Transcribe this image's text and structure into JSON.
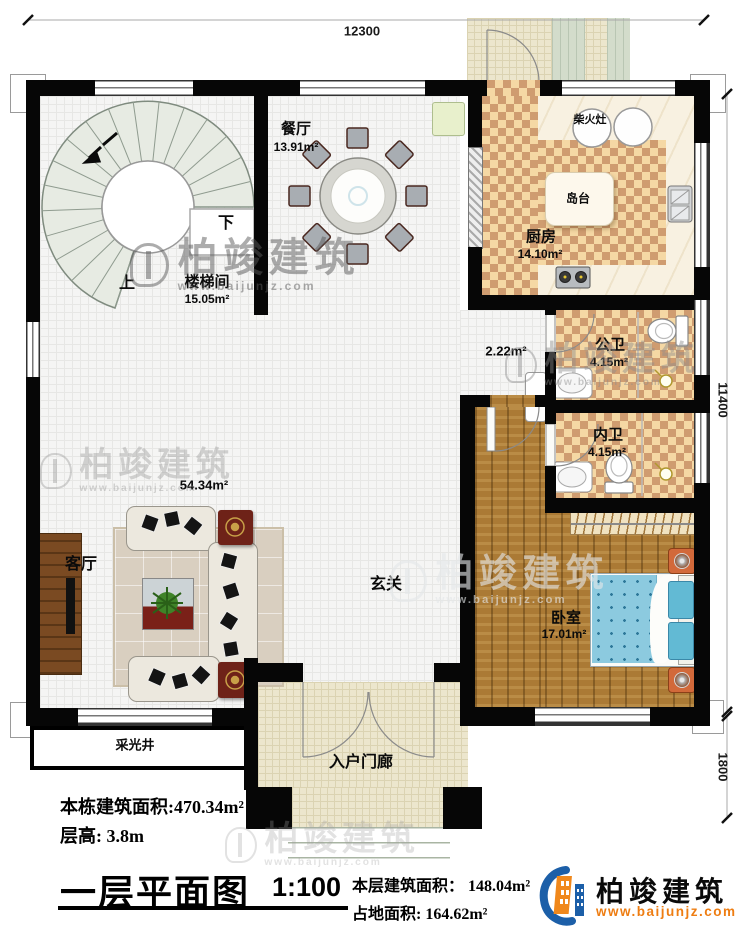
{
  "plan": {
    "dims": {
      "width": "12300",
      "height_main": "11400",
      "height_porch": "1800"
    },
    "stairwell": {
      "label": "楼梯间",
      "area": "15.05m²",
      "up": "上",
      "down": "下"
    },
    "dining": {
      "label": "餐厅",
      "area": "13.91m²"
    },
    "kitchen": {
      "label": "厨房",
      "area": "14.10m²",
      "island": "岛台",
      "wood_stove": "柴火灶"
    },
    "public_bath": {
      "label": "公卫",
      "area": "4.15m²"
    },
    "inner_bath": {
      "label": "内卫",
      "area": "4.15m²"
    },
    "corridor": {
      "area": "2.22m²"
    },
    "bedroom": {
      "label": "卧室",
      "area": "17.01m²"
    },
    "foyer": {
      "label": "玄关"
    },
    "living": {
      "label": "客厅",
      "area": "54.34m²"
    },
    "lightwell": {
      "label": "采光井"
    },
    "porch": {
      "label": "入户门廊"
    }
  },
  "footer": {
    "total_area": "本栋建筑面积:470.34m²",
    "floor_height": "层高: 3.8m",
    "title": "一层平面图",
    "scale": "1:100",
    "floor_area": "本层建筑面积： 148.04m²",
    "footprint": "占地面积: 164.62m²"
  },
  "brand": {
    "name": "柏竣建筑",
    "site": "www.baijunjz.com"
  },
  "watermark": {
    "name": "柏竣建筑",
    "site": "www.baijunjz.com"
  },
  "colors": {
    "wall": "#060606",
    "checker_light": "#f5d8a4",
    "checker_dark": "#cf9c70",
    "wood": "#ab7a35",
    "bed_blue": "#8ccadf",
    "brand_blue": "#1c5fa8",
    "brand_orange": "#f0881c"
  }
}
